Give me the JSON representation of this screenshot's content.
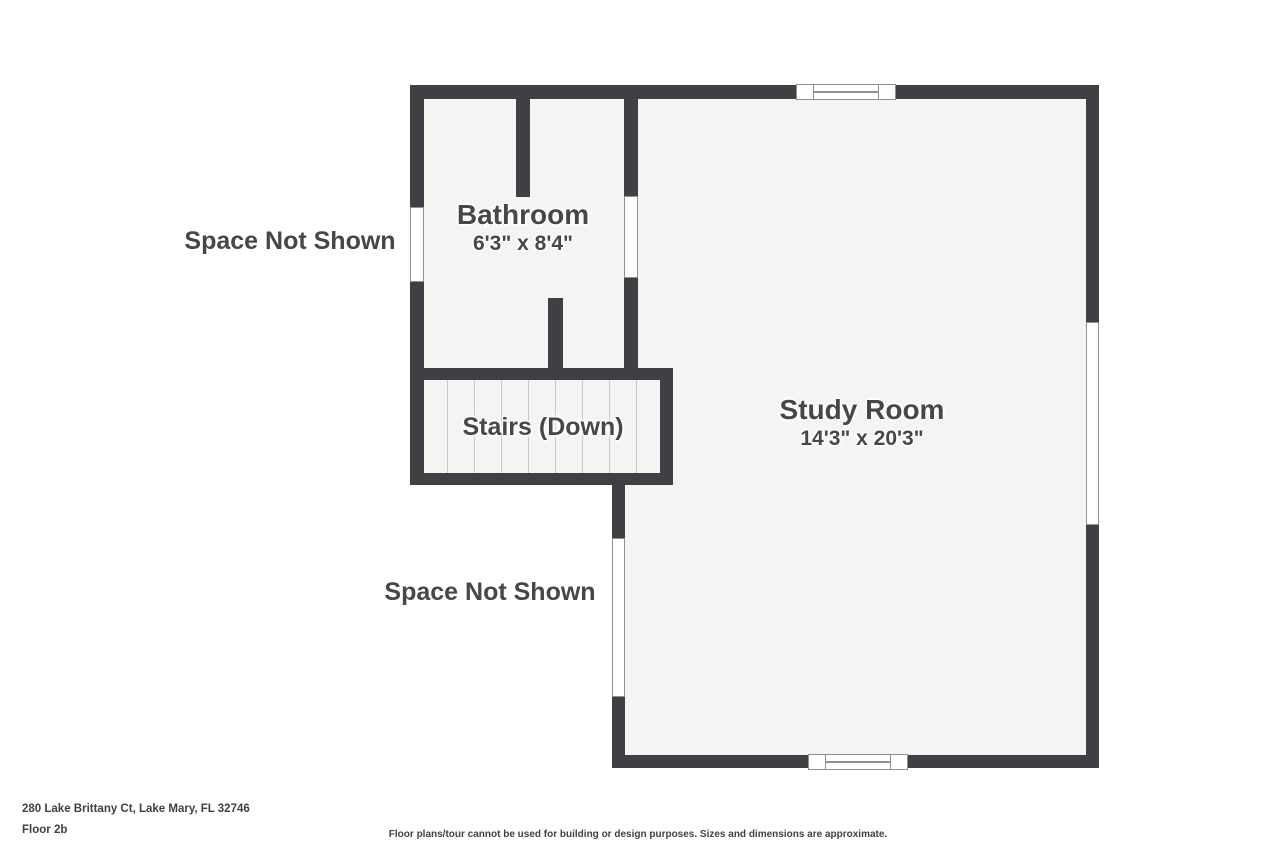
{
  "colors": {
    "wall": "#3e4044",
    "floor": "#f4f4f3",
    "background": "#ffffff",
    "tread_line": "#c9c9c9",
    "window_border": "#8f9194",
    "text": "#454749",
    "footer_text": "#3e4245"
  },
  "rooms": {
    "bathroom": {
      "name": "Bathroom",
      "dimensions": "6'3\" x 8'4\""
    },
    "stairs": {
      "name": "Stairs (Down)"
    },
    "study": {
      "name": "Study Room",
      "dimensions": "14'3\" x 20'3\""
    }
  },
  "annotations": {
    "space_not_shown_upper": "Space Not Shown",
    "space_not_shown_lower": "Space Not Shown"
  },
  "footer": {
    "address": "280 Lake Brittany Ct, Lake Mary, FL 32746",
    "floor_label": "Floor 2b",
    "disclaimer": "Floor plans/tour cannot be used for building or design purposes. Sizes and dimensions are approximate."
  }
}
